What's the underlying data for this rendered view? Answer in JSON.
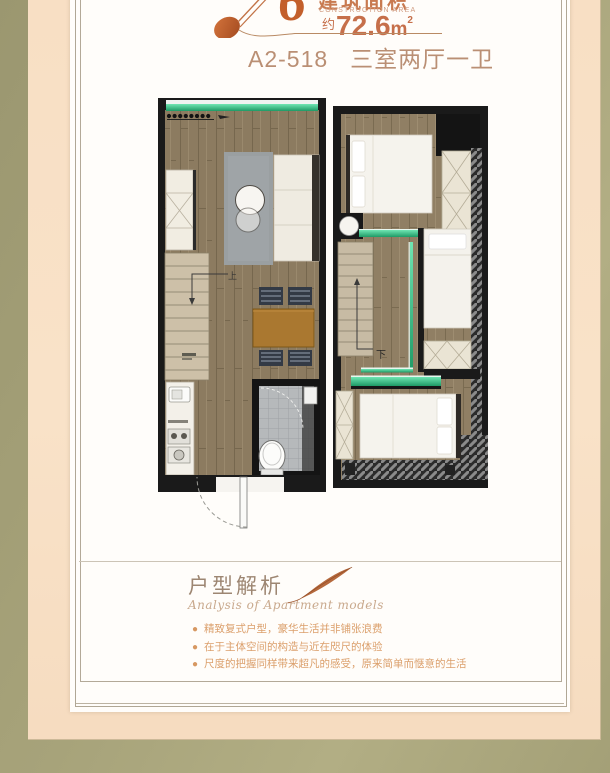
{
  "header": {
    "big_numeral": "6",
    "area_label_cn": "建筑面积",
    "area_label_en": "CONSTRUCTION AREA",
    "area_prefix": "约",
    "area_value": "72.6",
    "area_unit": "m",
    "area_unit_exp": "2",
    "unit_code": "A2-518",
    "unit_layout": "三室两厅一卫"
  },
  "floorplans": {
    "left_up_label": "上",
    "right_down_label": "下"
  },
  "analysis": {
    "title": "户型解析",
    "subtitle": "Analysis of Apartment models",
    "bullets": [
      "精致复式户型，豪华生活并非铺张浪费",
      "在于主体空间的构造与近在咫尺的体验",
      "尺度的把握同样带来超凡的感受，原来简单而惬意的生活"
    ]
  },
  "colors": {
    "accent_orange": "#c35f2b",
    "title_brown": "#ba8f74",
    "bullet_orange": "#db9f6b",
    "green_accent": "#3ecf8e",
    "background_olive": "#a7a37a",
    "panel_peach": "#f8dfc4"
  }
}
